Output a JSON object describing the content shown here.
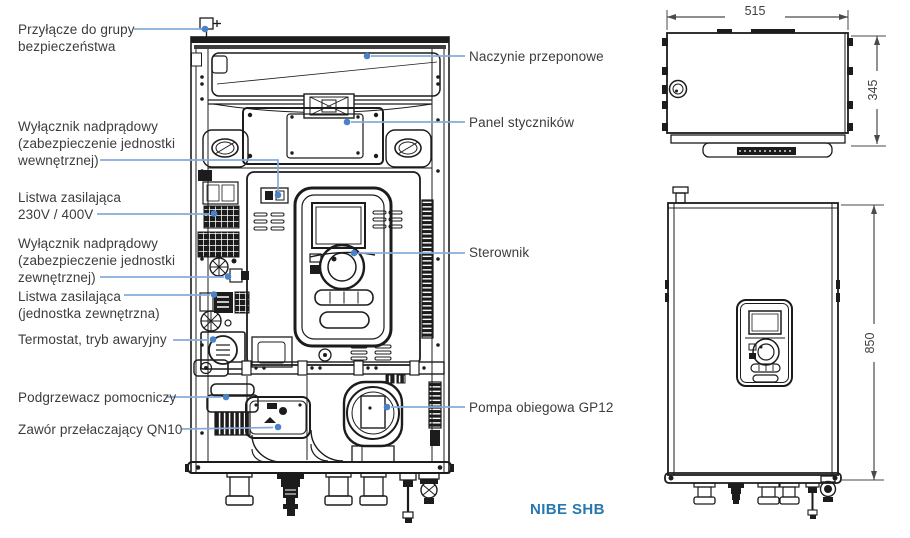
{
  "colors": {
    "linework": "#1c1c1c",
    "label_text": "#3c3c3c",
    "leader_line": "#86abd9",
    "leader_dot": "#4a82c8",
    "brand_text": "#2878b0",
    "dimension_text": "#3f3f3f"
  },
  "diagram": {
    "brand": "NIBE SHB",
    "callouts_left": [
      {
        "id": "safety-group-connection",
        "lines": [
          "Przyłącze do grupy",
          "bezpieczeństwa"
        ]
      },
      {
        "id": "breaker-indoor",
        "lines": [
          "Wyłącznik nadprądowy",
          "(zabezpieczenie jednostki",
          "wewnętrznej)"
        ]
      },
      {
        "id": "power-strip-230-400",
        "lines": [
          "Listwa zasilająca",
          "230V / 400V"
        ]
      },
      {
        "id": "breaker-outdoor",
        "lines": [
          "Wyłącznik nadprądowy",
          "(zabezpieczenie jednostki",
          "zewnętrznej)"
        ]
      },
      {
        "id": "power-strip-outdoor",
        "lines": [
          "Listwa zasilająca",
          "(jednostka zewnętrzna)"
        ]
      },
      {
        "id": "thermostat-emergency",
        "lines": [
          "Termostat, tryb awaryjny"
        ]
      },
      {
        "id": "auxiliary-heater",
        "lines": [
          "Podgrzewacz pomocniczy"
        ]
      },
      {
        "id": "switching-valve-qn10",
        "lines": [
          "Zawór przełaczający QN10"
        ]
      }
    ],
    "callouts_right": [
      {
        "id": "expansion-vessel",
        "text": "Naczynie przeponowe"
      },
      {
        "id": "contactor-panel",
        "text": "Panel styczników"
      },
      {
        "id": "controller",
        "text": "Sterownik"
      },
      {
        "id": "circulation-pump-gp12",
        "text": "Pompa obiegowa GP12"
      }
    ],
    "dimensions": {
      "width_mm": "515",
      "depth_mm": "345",
      "height_mm": "850"
    }
  }
}
